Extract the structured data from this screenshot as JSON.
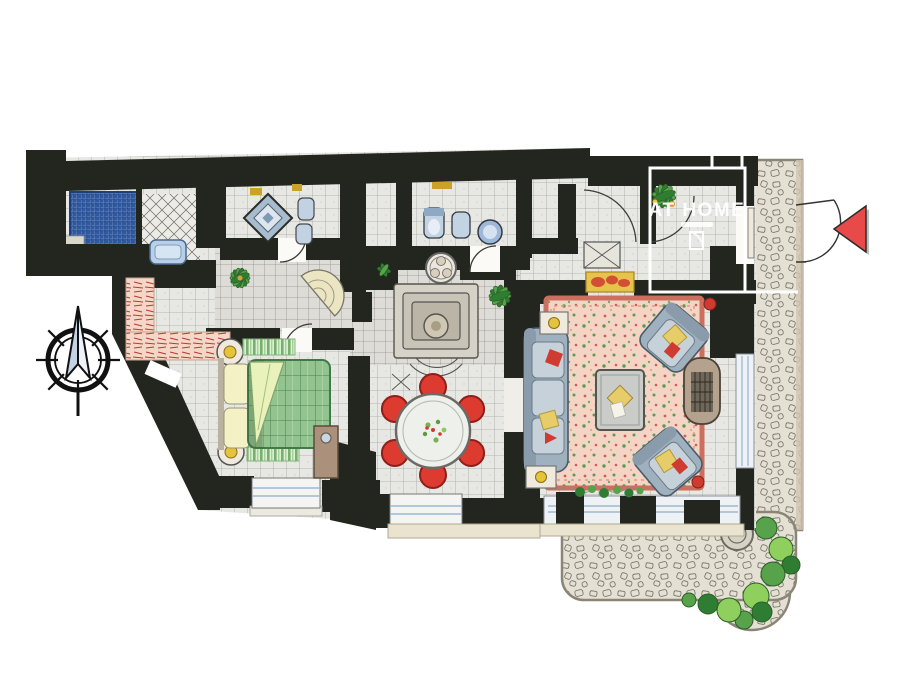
{
  "watermark": {
    "title": "AT HOME"
  },
  "palette": {
    "wall": "#23261f",
    "floor": "#e7e7e3",
    "floor_line": "#8f8f88",
    "floor_dark": "#dedcd6",
    "mosaic_blue": "#30589f",
    "tub_blue": "#b9cfe6",
    "bed_green": "#93c48f",
    "bed_grid": "#47804d",
    "pillow": "#f4f1c6",
    "rug_green": "#77b06d",
    "runner_pink": "#f5d7ca",
    "runner_red": "#b53a2c",
    "table_white": "#eef0ec",
    "chair_red": "#dd3a30",
    "carpet_pink": "#f3d4c5",
    "carpet_border": "#cc6f5e",
    "sofa_gray": "#9fb0bf",
    "cushion_light": "#c6d1da",
    "accent_yellow": "#e7cd6a",
    "accent_red": "#cf3b30",
    "wood": "#ab917c",
    "stone": "#e5e0d4",
    "stone_edge": "#8b8577",
    "leaf_green": "#57a24a",
    "leaf_dark": "#2f7d33",
    "lamp_yellow": "#e5c33b",
    "arrow_red": "#e84a4a",
    "glass_blue": "#9db8d2",
    "cream": "#efeadd"
  },
  "compass": {
    "spokes": 8
  },
  "dining": {
    "chairs": 6
  },
  "entrance_marker": {
    "shape": "triangle",
    "direction": "left"
  },
  "rooms": [
    {
      "id": "shower-room",
      "features": [
        "blue-mosaic-shower",
        "step"
      ]
    },
    {
      "id": "bathroom-tub",
      "features": [
        "bathtub",
        "diagonal-tiles"
      ]
    },
    {
      "id": "bathroom-diamond",
      "features": [
        "diamond-shower",
        "toilet",
        "bidet"
      ]
    },
    {
      "id": "wc",
      "features": [
        "toilet",
        "bidet",
        "round-washbasin"
      ]
    },
    {
      "id": "hallway",
      "features": [
        "potted-plant",
        "fan-step",
        "pink-runner-rug"
      ]
    },
    {
      "id": "bedroom",
      "features": [
        "double-bed",
        "two-nightstands",
        "two-lamps",
        "two-rugs",
        "wardrobe",
        "window"
      ]
    },
    {
      "id": "staircase",
      "features": [
        "steps",
        "newel",
        "rosette"
      ]
    },
    {
      "id": "dining-area",
      "features": [
        "round-table",
        "red-chairs",
        "window"
      ]
    },
    {
      "id": "living-room",
      "features": [
        "sofa",
        "two-armchairs",
        "coffee-table",
        "floral-carpet",
        "fireplace",
        "side-tables",
        "glazed-wall"
      ]
    },
    {
      "id": "entrance-hall",
      "features": [
        "doormat",
        "plant",
        "shaft",
        "front-door"
      ]
    },
    {
      "id": "stone-path",
      "features": [
        "cobblestones",
        "door-swing"
      ]
    },
    {
      "id": "terrace",
      "features": [
        "cobblestones",
        "stone-well",
        "bushes"
      ]
    }
  ]
}
